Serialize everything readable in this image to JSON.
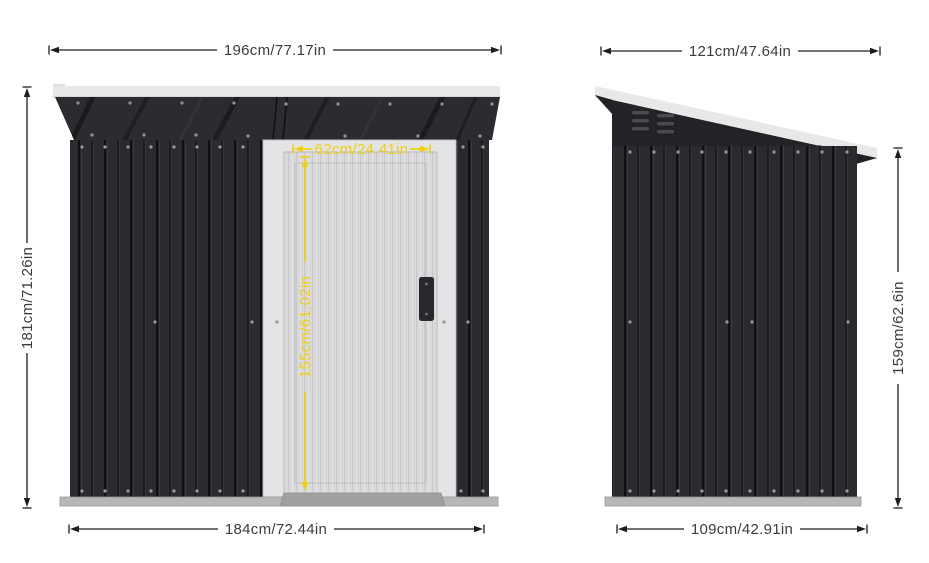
{
  "front_view": {
    "roof_width_label": "196cm/77.17in",
    "height_label": "181cm/71.26in",
    "base_width_label": "184cm/72.44in",
    "door_width_label": "62cm/24.41in",
    "door_height_label": "155cm/61.02in"
  },
  "side_view": {
    "roof_depth_label": "121cm/47.64in",
    "height_label": "159cm/62.6in",
    "base_depth_label": "109cm/42.91in"
  },
  "colors": {
    "dimension_line": "#1d1d1d",
    "dimension_text": "#3c3c3c",
    "door_annotation_yellow": "#eecf12",
    "shed_body_dark": "#2a2a2f",
    "roof_trim_white": "#e8e8e9",
    "door_panel_light": "#d9d9db",
    "base_rail_grey": "#b7b7b9"
  }
}
